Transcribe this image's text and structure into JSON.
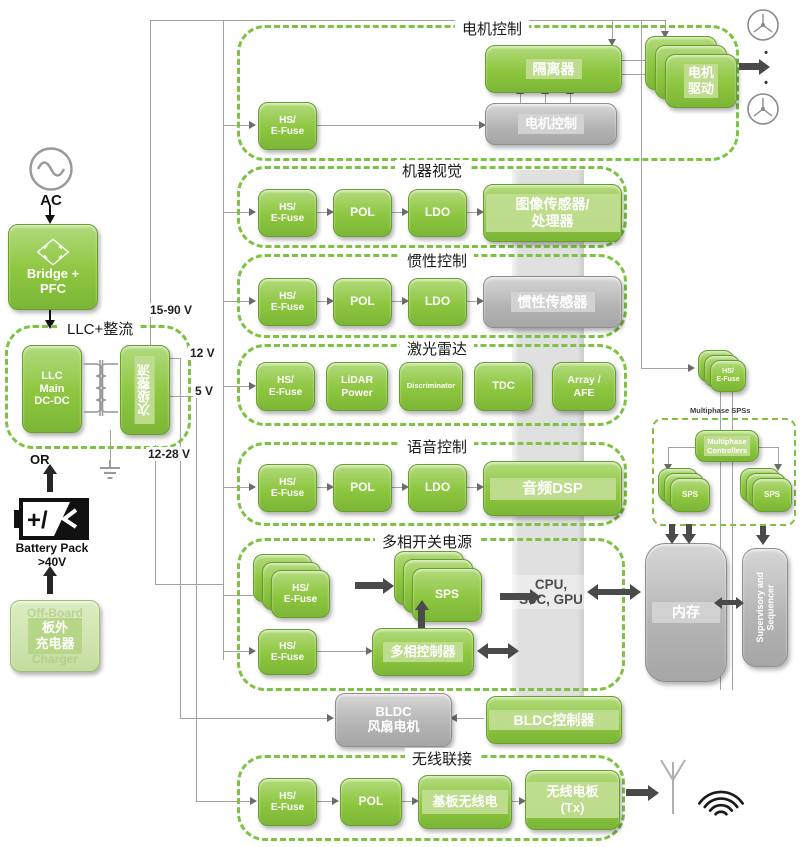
{
  "colors": {
    "green": "#8dc63f",
    "green_light": "#cfe4ad",
    "dashed_border": "#7dc242",
    "gray_block": "#b3b3b3",
    "bus_band": "#e0e0e0",
    "wire": "#a3a3a3",
    "arrow": "#4a4a4a"
  },
  "common": {
    "hs_efuse": "HS/\nE-Fuse",
    "pol": "POL",
    "ldo": "LDO",
    "sps": "SPS"
  },
  "source": {
    "ac": "AC",
    "bridge": "Bridge +\nPFC",
    "llc_title": "LLC+整流",
    "llc_main": "LLC\nMain\nDC-DC",
    "secondary_rect": "次级整流",
    "or_label": "OR",
    "battery": "Battery Pack\n>40V",
    "charger": "板外\n充电器",
    "charger_ghost_top": "Off-Board",
    "charger_ghost_bottom": "Charger"
  },
  "rails": {
    "r1": "15-90 V",
    "r2": "12 V",
    "r3": "5 V",
    "r4": "12-28 V"
  },
  "motor": {
    "title": "电机控制",
    "isolator": "隔离器",
    "controller": "电机控制",
    "driver": "电机\n驱动"
  },
  "vision": {
    "title": "机器视觉",
    "load": "图像传感器/\n处理器"
  },
  "inertial": {
    "title": "惯性控制",
    "load": "惯性传感器"
  },
  "lidar": {
    "title": "激光雷达",
    "power": "LiDAR\nPower",
    "discriminator": "Discriminator",
    "tdc": "TDC",
    "array": "Array /\nAFE"
  },
  "voice": {
    "title": "语音控制",
    "load": "音频DSP"
  },
  "multiphase": {
    "title": "多相开关电源",
    "controller": "多相控制器",
    "cpu": "CPU,\nSoC, GPU"
  },
  "bldc": {
    "motor": "BLDC\n风扇电机",
    "controller": "BLDC控制器"
  },
  "wireless": {
    "title": "无线联接",
    "radio": "基板无线电",
    "tx": "无线电板\n(Tx)"
  },
  "right": {
    "label": "Multiphase SPSs",
    "controllers": "Multiphase\nControllers",
    "memory": "内存",
    "supervisor": "Supervisory and\nSequencer"
  }
}
